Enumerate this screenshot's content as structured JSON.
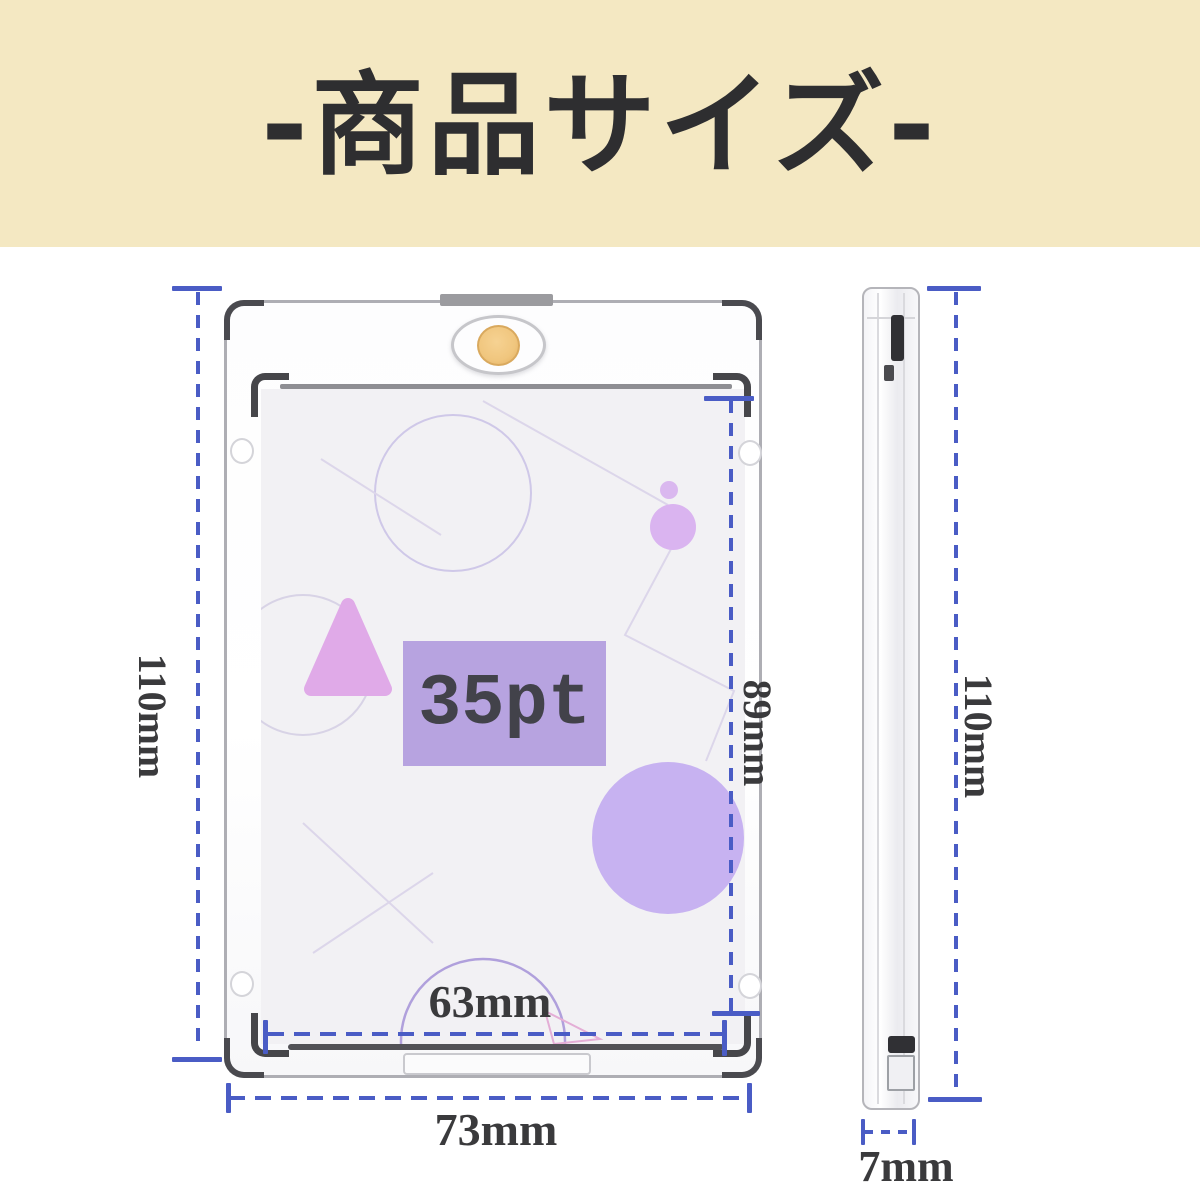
{
  "header": {
    "title": "-商品サイズ-"
  },
  "front_view": {
    "outer_height_label": "110mm",
    "inner_height_label": "89mm",
    "inner_width_label": "63mm",
    "outer_width_label": "73mm",
    "thickness_label": "35pt"
  },
  "side_view": {
    "height_label": "110mm",
    "thickness_label": "7mm"
  },
  "colors": {
    "header_bg": "#f4e8c2",
    "header_text": "#2e2e30",
    "measure_blue": "#4a5cc5",
    "dimension_text": "#3a3a3c",
    "badge_purple": "#b7a3e0",
    "big_circle_purple": "#c7b2f1",
    "triangle_pink": "#e0aae8",
    "gold_magnet": "#f0c67e",
    "card_background": "#f2f1f4"
  }
}
